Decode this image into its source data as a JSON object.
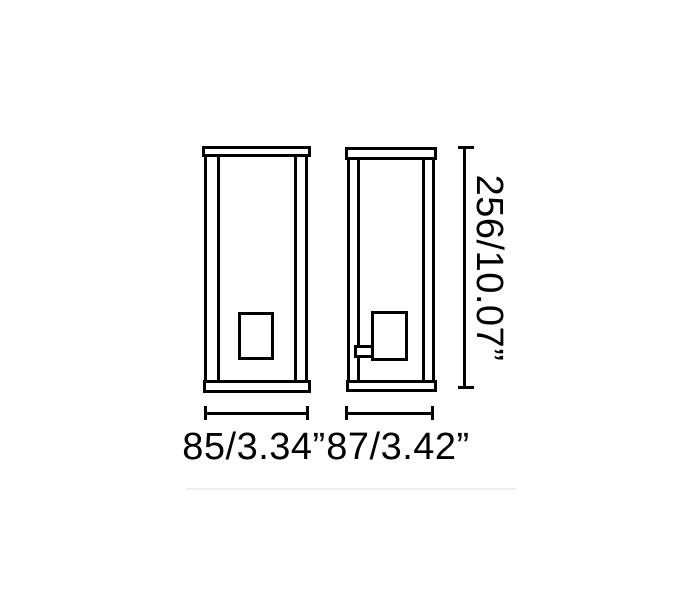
{
  "page": {
    "background": "#ffffff"
  },
  "drawing": {
    "type": "technical-dimension-diagram",
    "subject": "rectangular lantern wall lamp, front and side elevation views",
    "line_color": "#000000",
    "divider_color": "#ededed",
    "labels": {
      "front_width": "85/3.34”",
      "side_depth": "87/3.42”",
      "height": "256/10.07”"
    },
    "dimensions": {
      "front_width_mm": "85",
      "front_width_in": "3.34",
      "side_depth_mm": "87",
      "side_depth_in": "3.42",
      "height_mm": "256",
      "height_in": "10.07"
    }
  }
}
